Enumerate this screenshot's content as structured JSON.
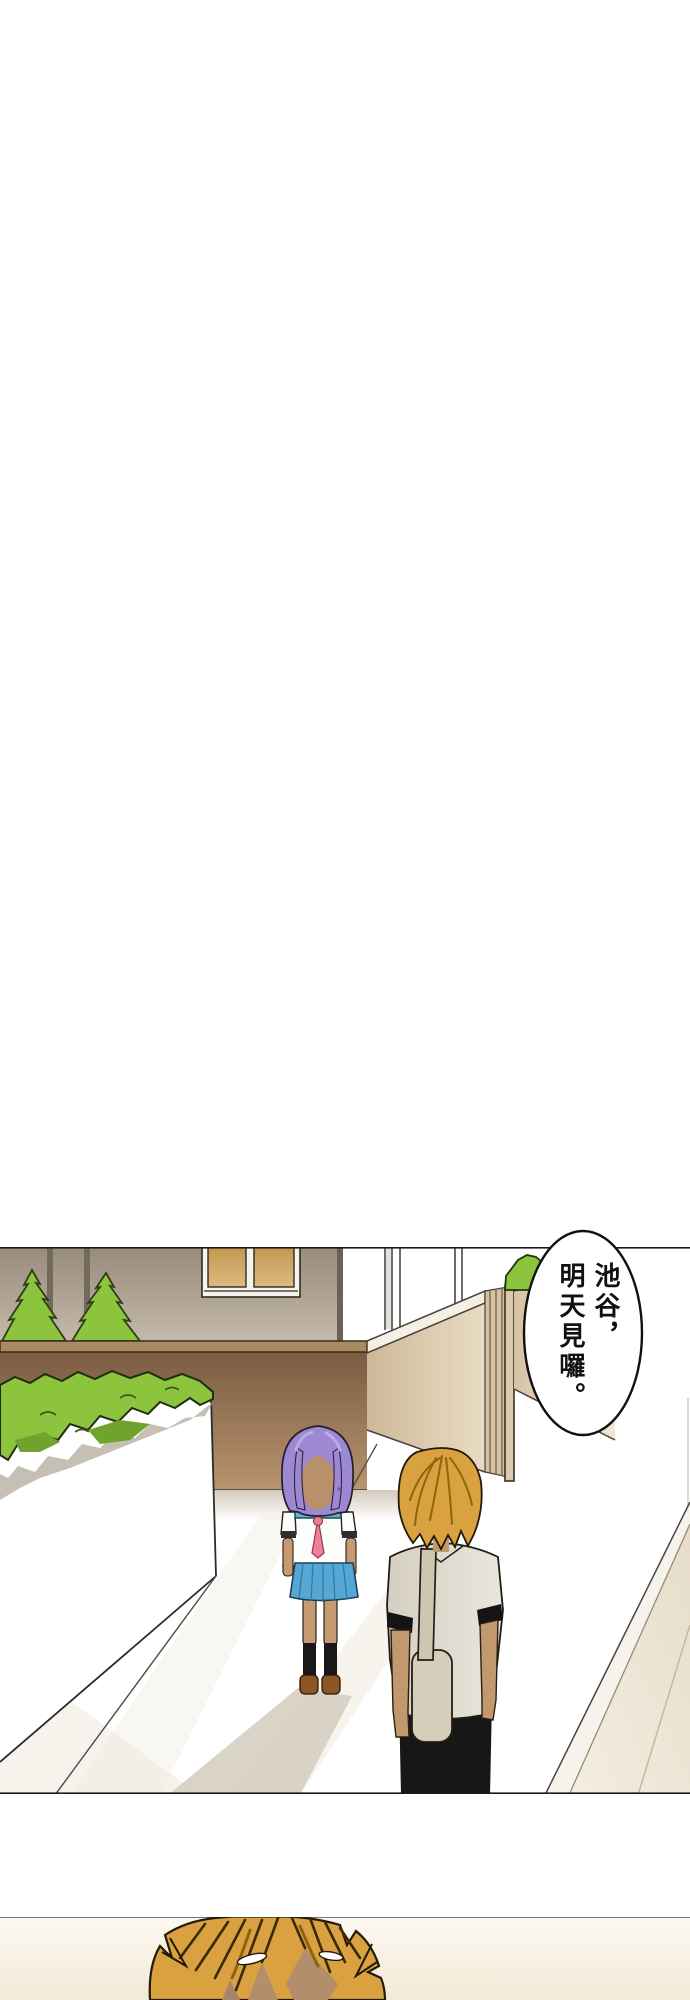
{
  "page": {
    "kind": "webtoon-comic-page",
    "width": 690,
    "height": 2000,
    "background": "#ffffff"
  },
  "panel1": {
    "label": "street-scene-panel",
    "top": 1247,
    "bottom": 1795,
    "description": "Purple-haired schoolgirl and orange-haired boy standing on a walkway between a tan building, green hedge and cream fence"
  },
  "panel2": {
    "label": "closeup-panel",
    "top": 1916,
    "bottom": 2000,
    "description": "Close-up of the top of an orange-haired head"
  },
  "bubble": {
    "line1": "池谷，",
    "line2": "明天見囉。",
    "full_text": "池谷，明天見囉。",
    "fill": "#ffffff",
    "text_color": "#111111"
  },
  "palette": {
    "panel_border": "#1b1b1b",
    "bldg_wall_top": "#978b7b",
    "bldg_wall_bottom": "#c6bbac",
    "bldg_corner": "#6b6154",
    "pipe": "#746a5c",
    "window_frame": "#f6f3ea",
    "window_pane_top": "#c2964e",
    "window_pane_bottom": "#dcbc82",
    "tree_green": "#8cc43e",
    "tree_green_dark": "#70a22e",
    "hedge_green": "#8cc43e",
    "hedge_shadow": "#c6bfb3",
    "brown_wall_cap": "#a98a63",
    "brown_wall_top": "#7b5c41",
    "brown_wall_bottom": "#b8946f",
    "fence_light": "#efe6d2",
    "fence_dark": "#cdb897",
    "fence_cap": "#f6f3ec",
    "slat_line": "#7c684e",
    "girl_hair": "#9d88d2",
    "girl_hair_light": "#bcaae6",
    "girl_collar": "#5cb6c8",
    "girl_tie": "#ee8096",
    "girl_skirt": "#57a7d4",
    "girl_skirt_pleat": "#2d7aa6",
    "skin": "#c2996f",
    "face_shadow": "#b9906c",
    "sock_black": "#191919",
    "shoe_brown": "#8d5524",
    "boy_hair": "#d9a13f",
    "boy_hair_dark": "#8f6410",
    "boy_shirt": "#ddd6c9",
    "boy_strap": "#cfc6b2",
    "boy_bag": "#d7cdbb",
    "pants_black": "#171717",
    "shadow_grey": "#d5cec2",
    "ground_streak": "#f2ede3",
    "closeup_bg_top": "#fcf9f2",
    "closeup_bg_bottom": "#f3e9d6",
    "closeup_skin": "#b28e6d"
  }
}
